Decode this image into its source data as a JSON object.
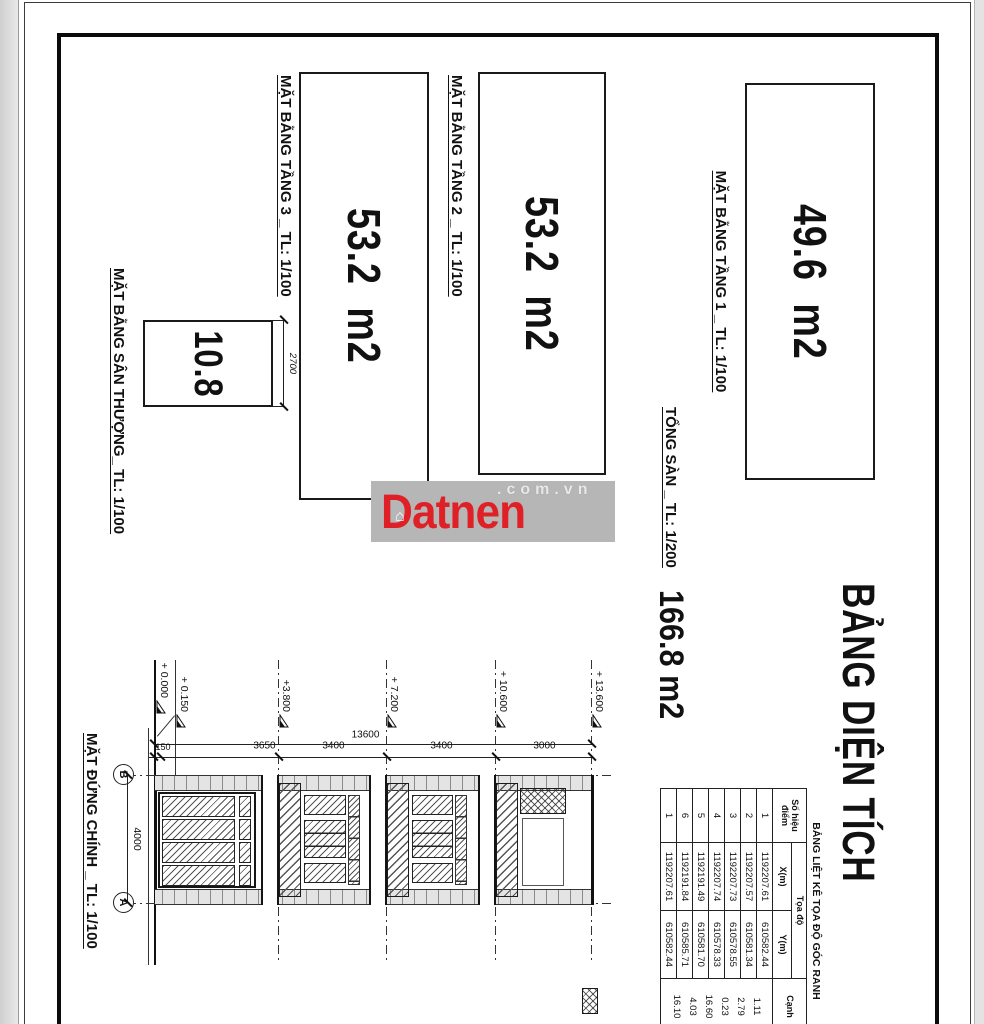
{
  "watermark": {
    "brand": "Datnen",
    "suffix": ".com.vn",
    "house_glyph": "⌂",
    "red": "#df2127",
    "band_gray": "#b6b6b6"
  },
  "sheet_title": "BẢNG DIỆN TÍCH",
  "plans": [
    {
      "label": "MẶT BẰNG TẦNG 1 _ TL: 1/100",
      "area": "49.6  m2"
    },
    {
      "label": "MẶT BẰNG TẦNG 2 _ TL: 1/100",
      "area": "53.2  m2"
    },
    {
      "label": "MẶT BẰNG TẦNG 3 _ TL: 1/100",
      "area": "53.2  m2"
    },
    {
      "label": "MẶT BẰNG SÂN THƯỢNG_ TL: 1/100",
      "area": "10.8",
      "height_dim": "2700"
    }
  ],
  "total": {
    "label": "TỔNG SÀN _ TL: 1/200",
    "value": "166.8 m2"
  },
  "elevation": {
    "label": "MẶT ĐỨNG CHÍNH _ TL: 1/100",
    "levels": [
      "+ 13.600",
      "+ 10.600",
      "+ 7.200",
      "+3.800",
      "+ 0.150",
      "+ 0.000"
    ],
    "overall_dim": "13600",
    "storey_dims": [
      "3000",
      "3400",
      "3400",
      "3650",
      "150"
    ],
    "width_dim": "4000",
    "grid_top": "B",
    "grid_bottom": "A"
  },
  "coord_table": {
    "title": "BẢNG LIỆT KÊ TỌA ĐỘ GÓC RANH",
    "headers": {
      "point": "Số hiệu điểm",
      "coord": "Tọa độ",
      "x": "X(m)",
      "y": "Y(m)",
      "edge": "Cạnh"
    },
    "rows": [
      {
        "n": "1",
        "x": "1192207.61",
        "y": "610582.44",
        "edge": "1.11"
      },
      {
        "n": "2",
        "x": "1192207.57",
        "y": "610581.34",
        "edge": "2.79"
      },
      {
        "n": "3",
        "x": "1192207.73",
        "y": "610578.55",
        "edge": "0.23"
      },
      {
        "n": "4",
        "x": "1192207.74",
        "y": "610578.33",
        "edge": "16.60"
      },
      {
        "n": "5",
        "x": "1192191.49",
        "y": "610581.70",
        "edge": "4.03"
      },
      {
        "n": "6",
        "x": "1192191.84",
        "y": "610585.71",
        "edge": "16.10"
      },
      {
        "n": "1",
        "x": "1192207.61",
        "y": "610582.44",
        "edge": ""
      }
    ]
  }
}
